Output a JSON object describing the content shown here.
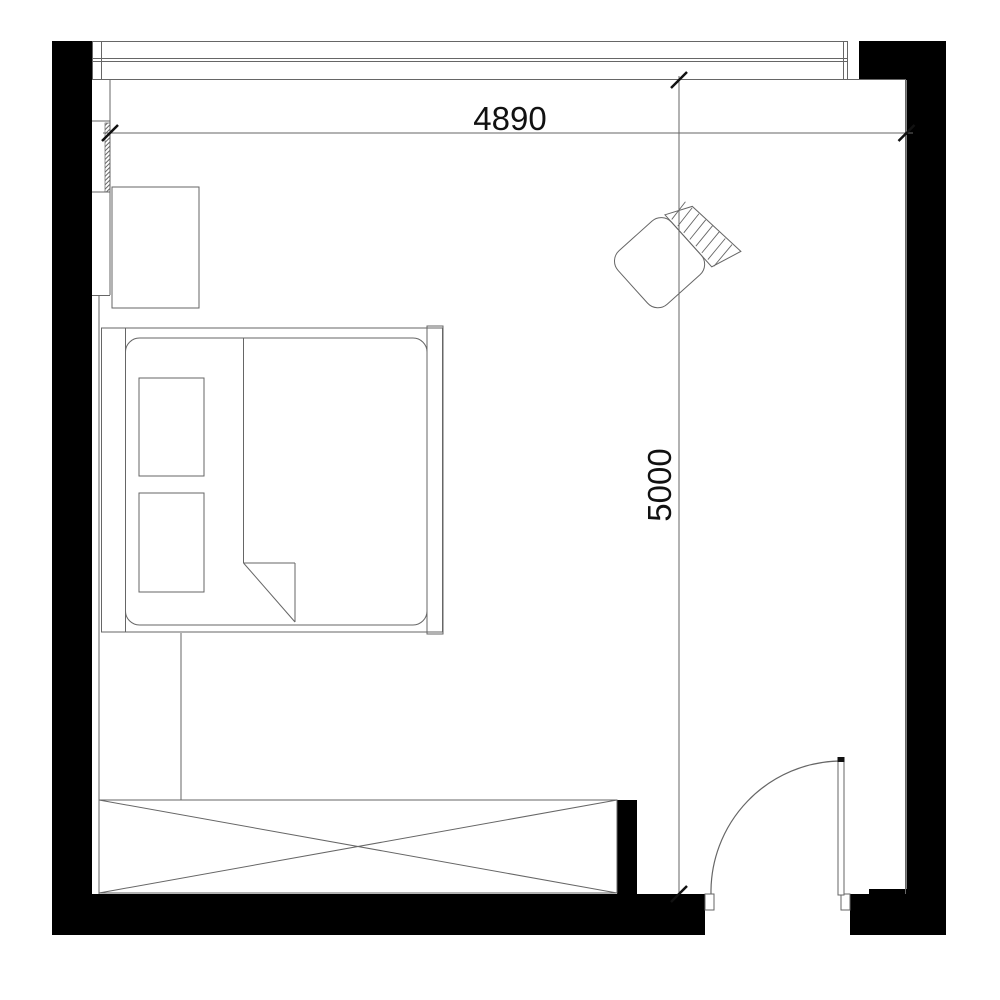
{
  "page": {
    "title": "Bedroom floor plan"
  },
  "dimensions": {
    "horizontal_label": "4890",
    "vertical_label": "5000"
  },
  "colors": {
    "background": "#ffffff",
    "wall_fill": "#000000",
    "line": "#666666",
    "tick": "#111111",
    "text": "#111111"
  },
  "furniture": {
    "window": "window-band",
    "bed": "double-bed",
    "mattress": "mattress",
    "pillow_1": "pillow",
    "pillow_2": "pillow",
    "blanket": "duvet-folded-corner",
    "nightstand": "nightstand",
    "armchair": "armchair",
    "dresser": "dresser-crossed",
    "door": "swing-door",
    "divider": "wardrobe-divider-line",
    "wall_strip": "wall-hatch-strip"
  }
}
